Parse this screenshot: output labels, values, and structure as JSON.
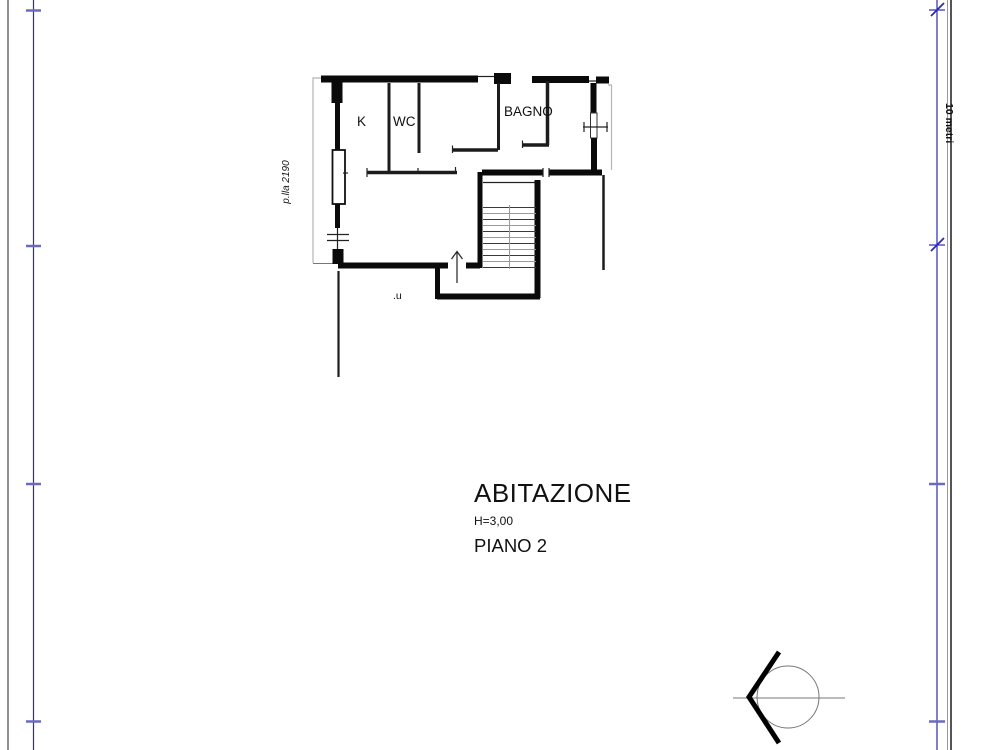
{
  "drawing": {
    "type": "architectural floor plan (catasto style)",
    "rooms": {
      "kitchen_label": "K",
      "wc_label": "WC",
      "bathroom_label": "BAGNO"
    },
    "parcel_label": "p.lla 2190",
    "entry_label": ".u",
    "title_block": {
      "title": "ABITAZIONE",
      "height_note": "H=3,00",
      "floor_label": "PIANO 2"
    },
    "scale_bar": {
      "label": "10 metri"
    },
    "colors": {
      "dimension_blue": "#2b2bb2",
      "tick_blue": "#6a6ac0",
      "wall_black": "#0a0a0a",
      "boundary_gray": "#b3b3b3",
      "frame_gray": "#666666"
    }
  }
}
